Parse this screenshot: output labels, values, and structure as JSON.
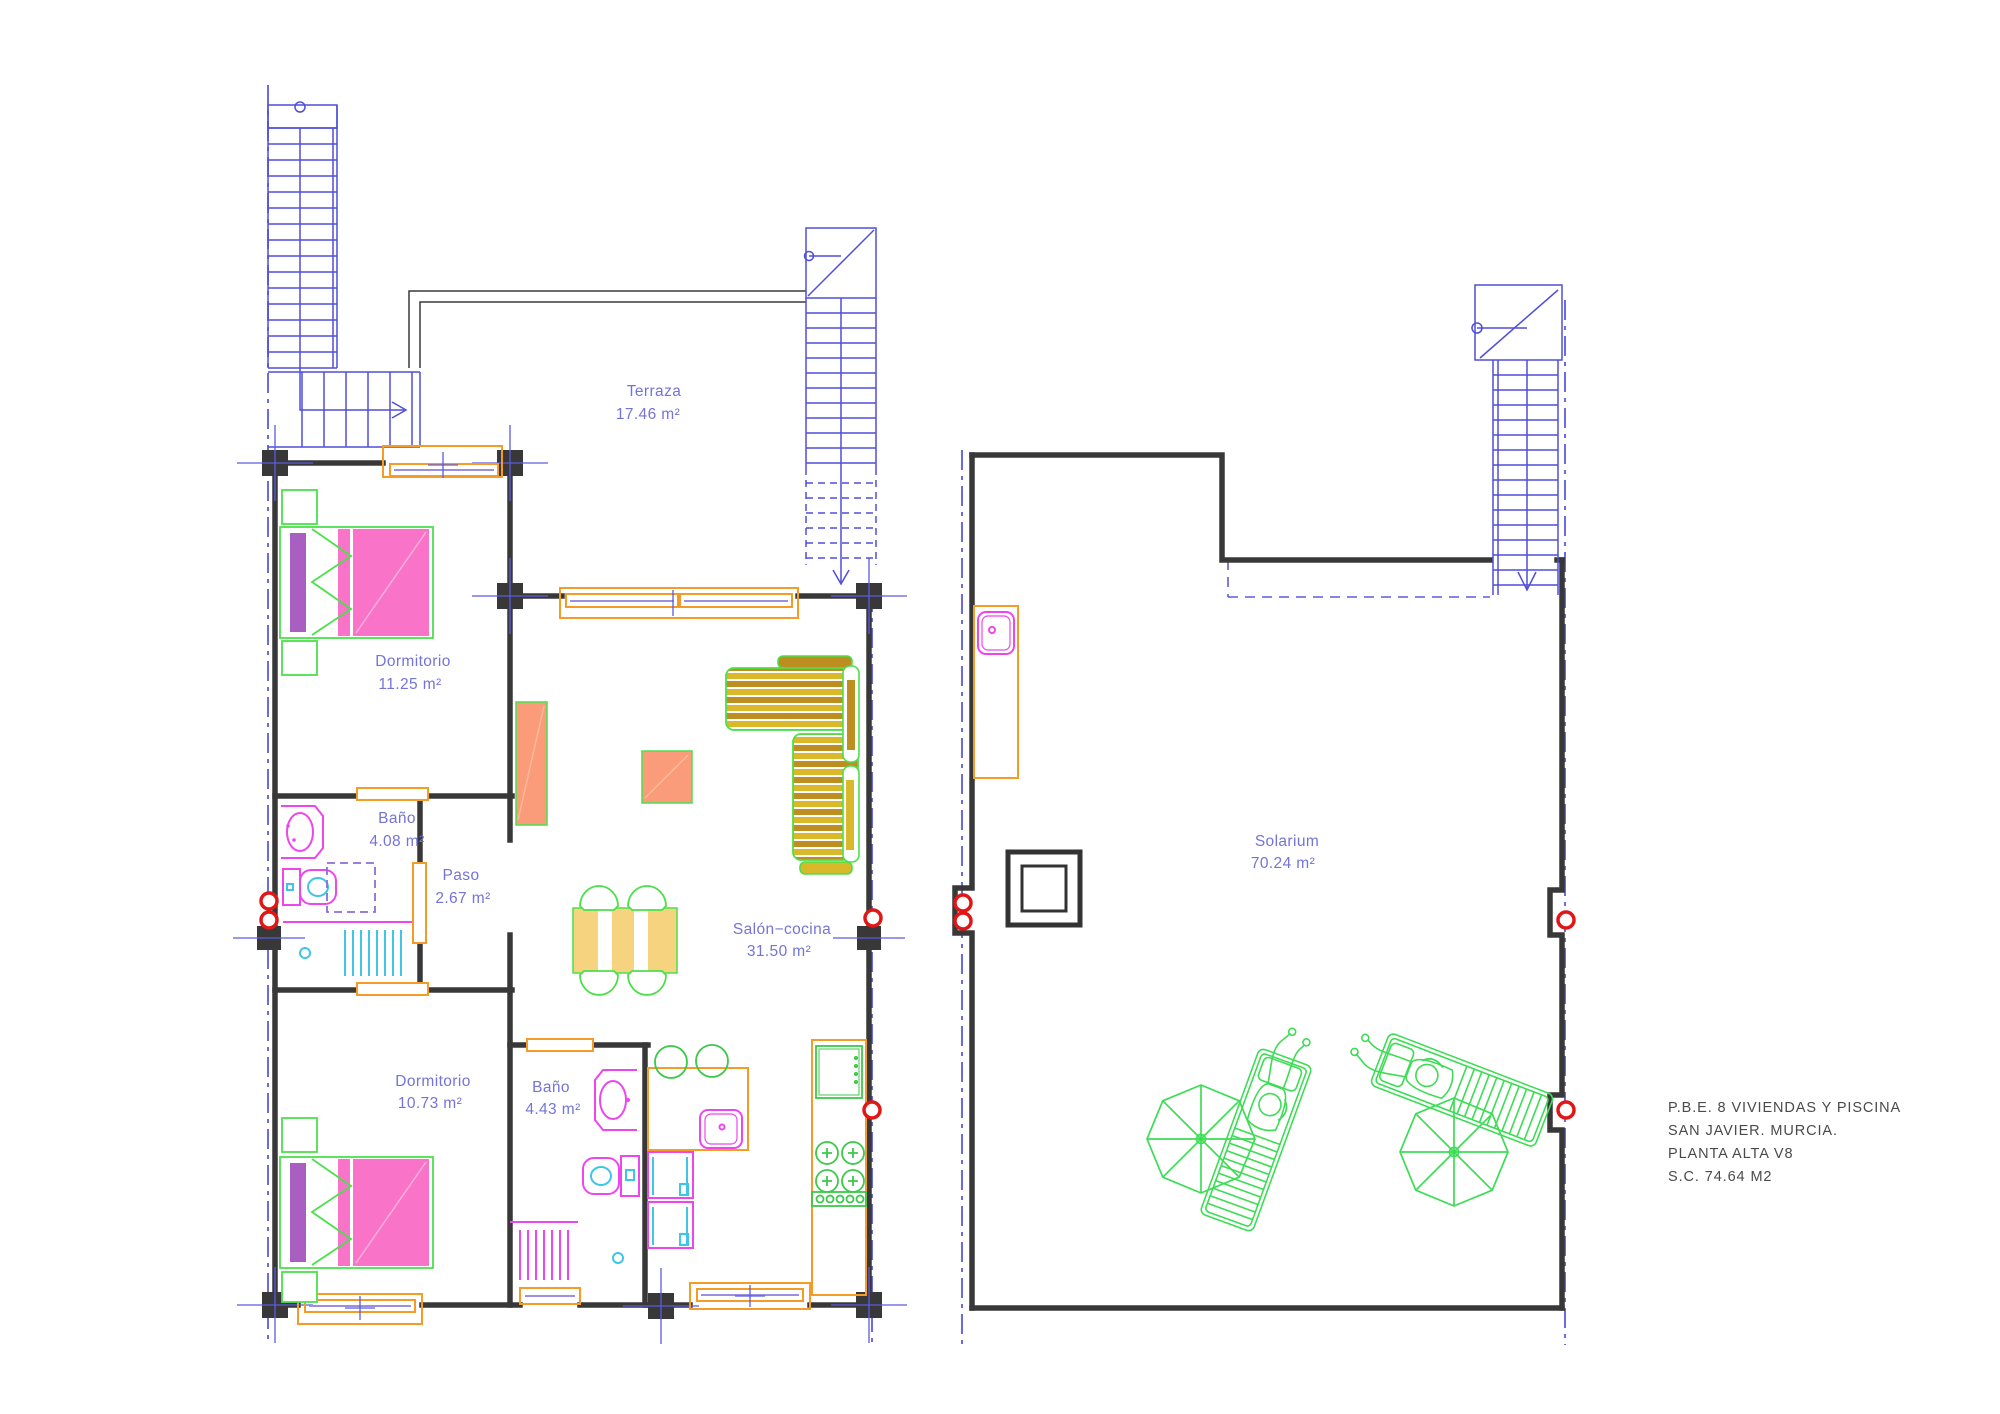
{
  "title_block": {
    "lines": [
      "P.B.E. 8 VIVIENDAS Y PISCINA",
      "SAN JAVIER. MURCIA.",
      "PLANTA ALTA V8",
      "S.C. 74.64 M2"
    ]
  },
  "rooms": {
    "terraza": {
      "name": "Terraza",
      "area": "17.46 m²"
    },
    "dormitorio1": {
      "name": "Dormitorio",
      "area": "11.25 m²"
    },
    "bano1": {
      "name": "Baño",
      "area": "4.08 m²"
    },
    "paso": {
      "name": "Paso",
      "area": "2.67 m²"
    },
    "salon": {
      "name": "Salón−cocina",
      "area": "31.50 m²"
    },
    "dormitorio2": {
      "name": "Dormitorio",
      "area": "10.73 m²"
    },
    "bano2": {
      "name": "Baño",
      "area": "4.43 m²"
    },
    "solarium": {
      "name": "Solarium",
      "area": "70.24 m²"
    }
  },
  "colors": {
    "wall": "#383838",
    "stair_blue": "#4f4fd8",
    "label_blue": "#7474d8",
    "boundary_blue": "#5b5be0",
    "carpentry_orange": "#f59b28",
    "glass_purple": "#9a8fe0",
    "bed_pink": "#f973c9",
    "headboard_purple": "#a95fc1",
    "furniture_green": "#4be04b",
    "sofa_gold": "#d9b92a",
    "sofa_ochre": "#bf8e20",
    "table_tan": "#f6d47f",
    "wood_salmon": "#fa9c79",
    "fixture_magenta": "#ee46ee",
    "fixture_cyan": "#3fc6e6",
    "appliance_green": "#3cc84a",
    "marker_red": "#e11717",
    "outdoor_green": "#3ddc55",
    "title_gray": "#4a4a4a"
  }
}
